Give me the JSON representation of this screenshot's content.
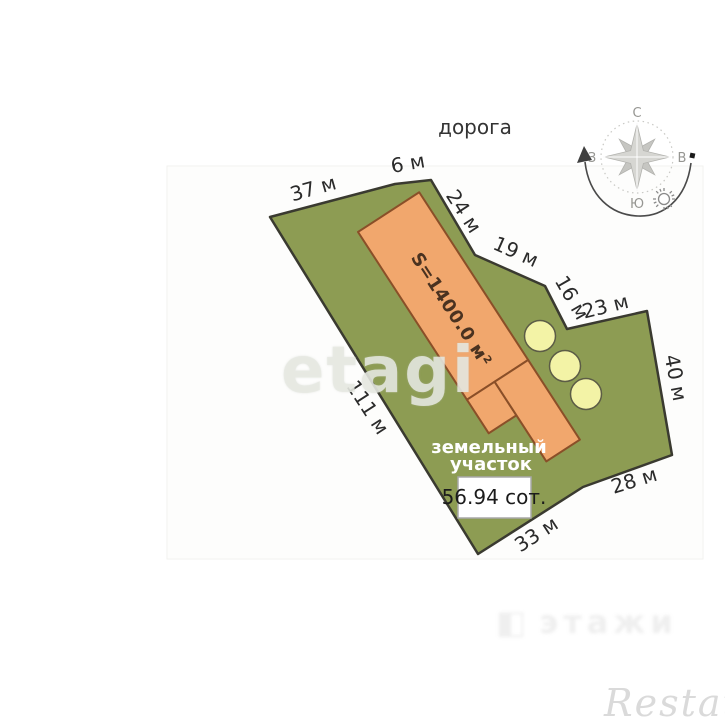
{
  "plan": {
    "road_label": "дорога",
    "dimensions": [
      "37 м",
      "6 м",
      "24 м",
      "19 м",
      "16 м",
      "23 м",
      "40 м",
      "28 м",
      "33 м",
      "111 м"
    ],
    "parcel_label_line1": "земельный",
    "parcel_label_line2": "участок",
    "parcel_area": "56.94 сот.",
    "building_area": "S=1400.0 м²"
  },
  "compass": {
    "north": "С",
    "east": "В",
    "south": "Ю",
    "west": "З"
  },
  "watermarks": {
    "brand": "etagi",
    "center": "этажи",
    "agency": "Restate"
  },
  "colors": {
    "parcel_fill": "#8d9c53",
    "parcel_outline": "#3a3a30",
    "building_fill": "#f1a76d",
    "building_outline": "#8a4f28",
    "tree_fill": "#f3f3a6",
    "tree_outline": "#5c5c46"
  }
}
